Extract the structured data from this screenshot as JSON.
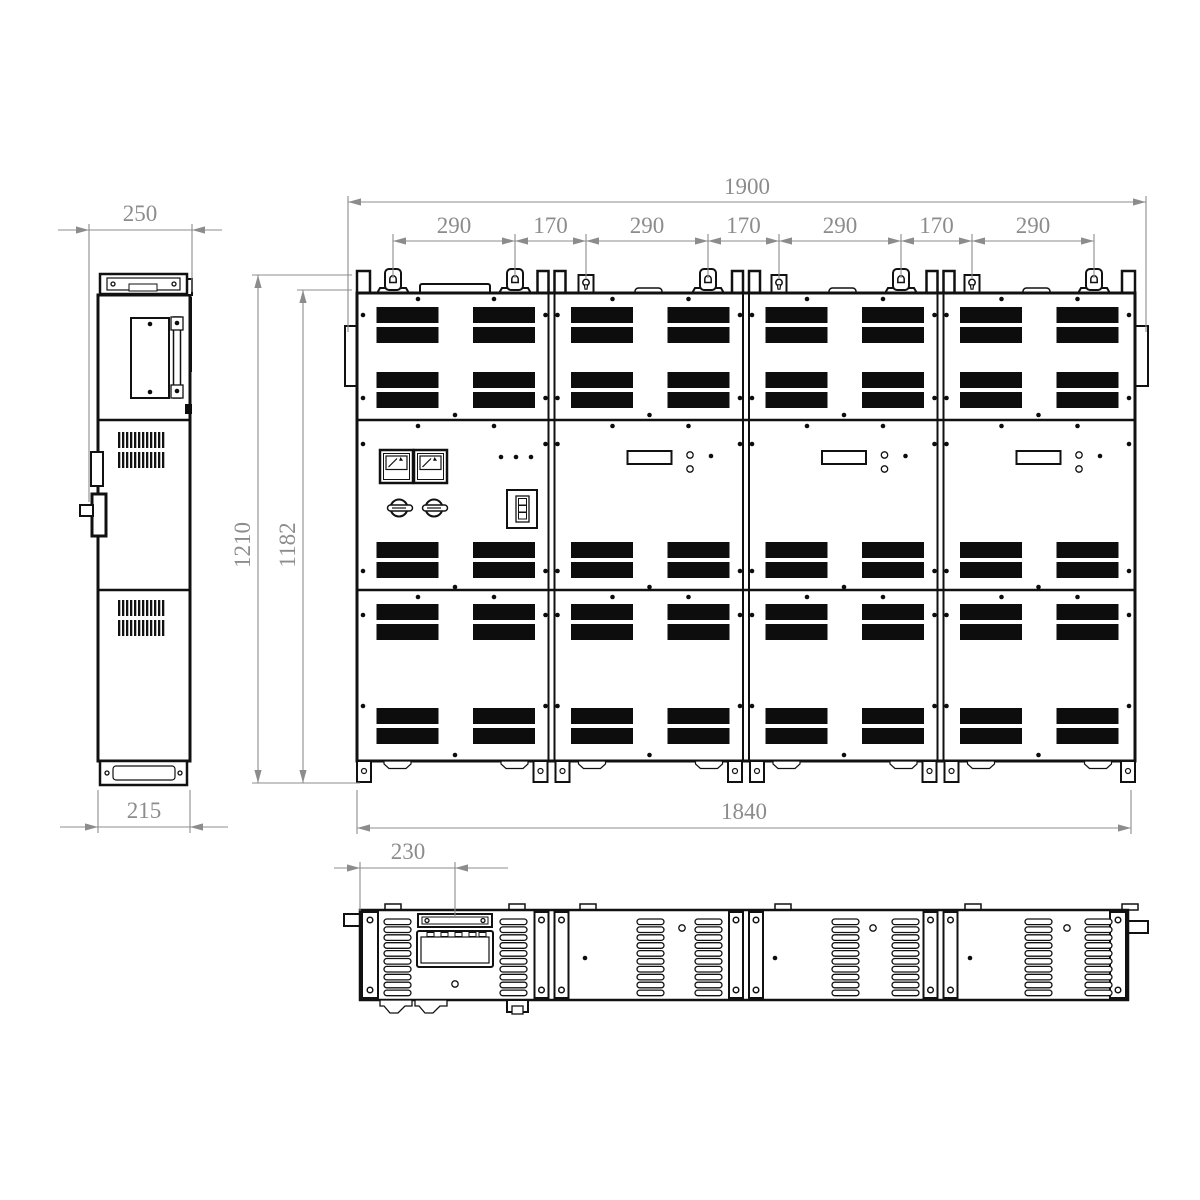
{
  "drawing": {
    "type": "technical-drawing-three-view",
    "subject": "modular-electrical-cabinet",
    "colors": {
      "background": "#ffffff",
      "lines": "#111111",
      "dimensions": "#8c8c8c"
    },
    "views": {
      "side": "side-view",
      "front": "front-view",
      "top": "top-view"
    },
    "dims": {
      "overall_width": "1900",
      "chain": [
        "290",
        "170",
        "290",
        "170",
        "290",
        "170",
        "290"
      ],
      "depth_top": "250",
      "overall_height": "1210",
      "body_height": "1182",
      "depth_bottom": "215",
      "base_width": "1840",
      "top_view_offset": "230"
    }
  }
}
